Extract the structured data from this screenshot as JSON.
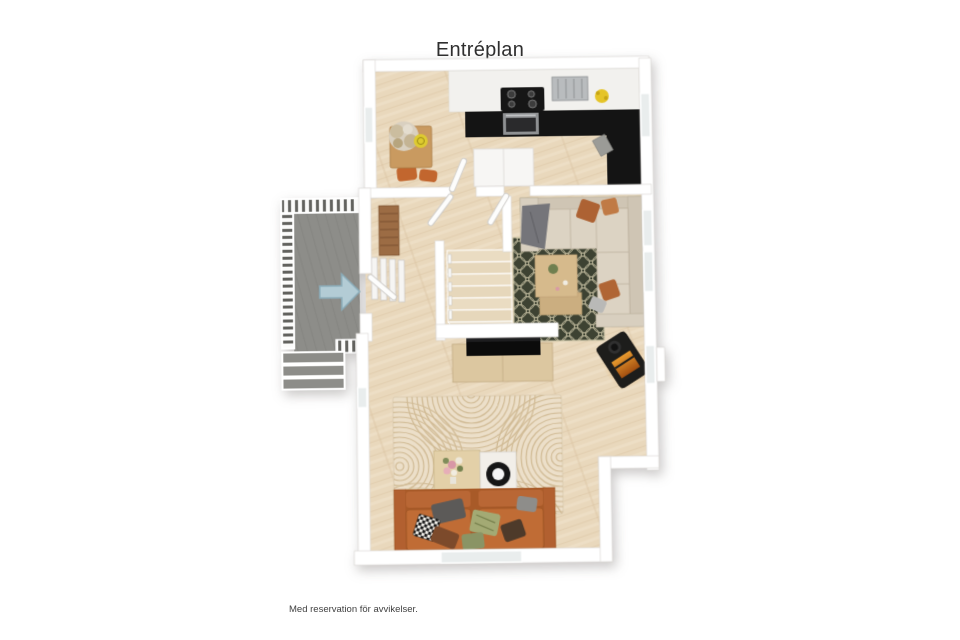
{
  "header": {
    "title": "Entréplan"
  },
  "footer": {
    "disclaimer": "Med reservation för avvikelser."
  },
  "floorplan": {
    "view": "3D top-down floor plan",
    "entrance_arrow_direction": "right"
  },
  "colors": {
    "wall": "#ffffff",
    "floor_wood": "#e9d8bc",
    "floor_line": "#d9c3a1",
    "deck": "#8d8d89",
    "arrow_fill": "#b3ccd5",
    "arrow_stroke": "#8aacb9",
    "counter_black": "#141414",
    "rug_green": "#3d4232",
    "rug_pattern": "#c6c0a2",
    "rug_beige": "#ecdfc9",
    "rug_arc": "#d0ba94",
    "sofa_beige": "#d8cfbf",
    "sofa_orange": "#c06c35",
    "table_wood": "#c99a60",
    "fire_glow": "#e89a2e",
    "title_color": "#2f2f2f",
    "text_color": "#404040"
  }
}
